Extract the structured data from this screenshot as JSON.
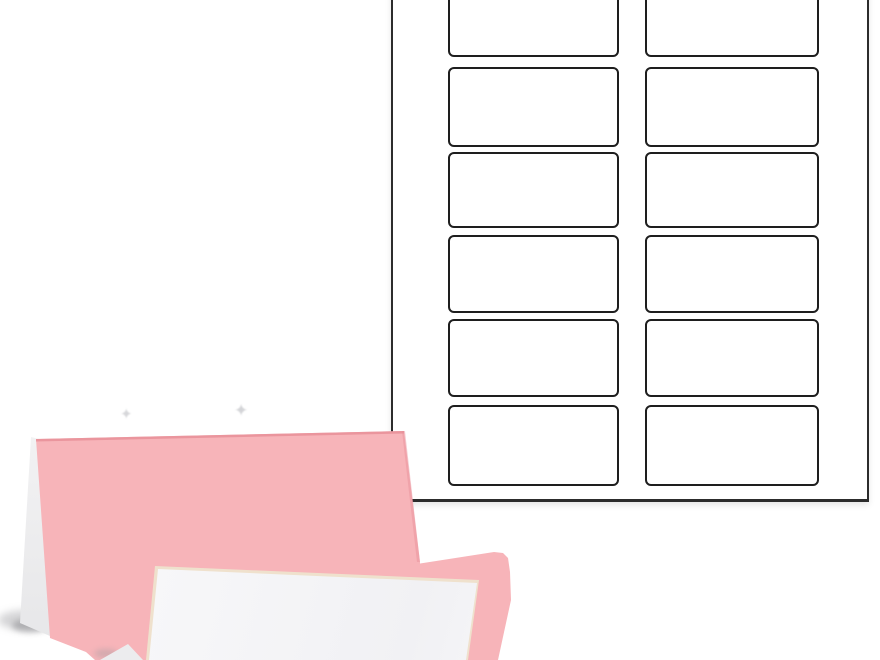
{
  "scene": {
    "subject": "blank pink tent-style place cards in front of a blank die-cut printable template sheet",
    "visible_text": ""
  },
  "template_sheet": {
    "columns": 2,
    "visible_rows_per_column": 6,
    "total_visible_cells": 12
  },
  "decorations": {
    "sparkle_glyph": "✦",
    "sparkle_count": 2
  },
  "colors": {
    "background": "#ffffff",
    "sheet_paper": "#ffffff",
    "sheet_outline": "#2c2c2c",
    "cell_outline": "#1e1e1e",
    "card_pink": "#f7b4b9",
    "card_pink_edge": "#e78f98",
    "panel_white": "#f4f4f6",
    "panel_edge_cream": "#efe1cd",
    "flap_white": "#fdfdfd",
    "shadow_gray": "#a0a0a4",
    "sparkle": "#c9cace"
  }
}
